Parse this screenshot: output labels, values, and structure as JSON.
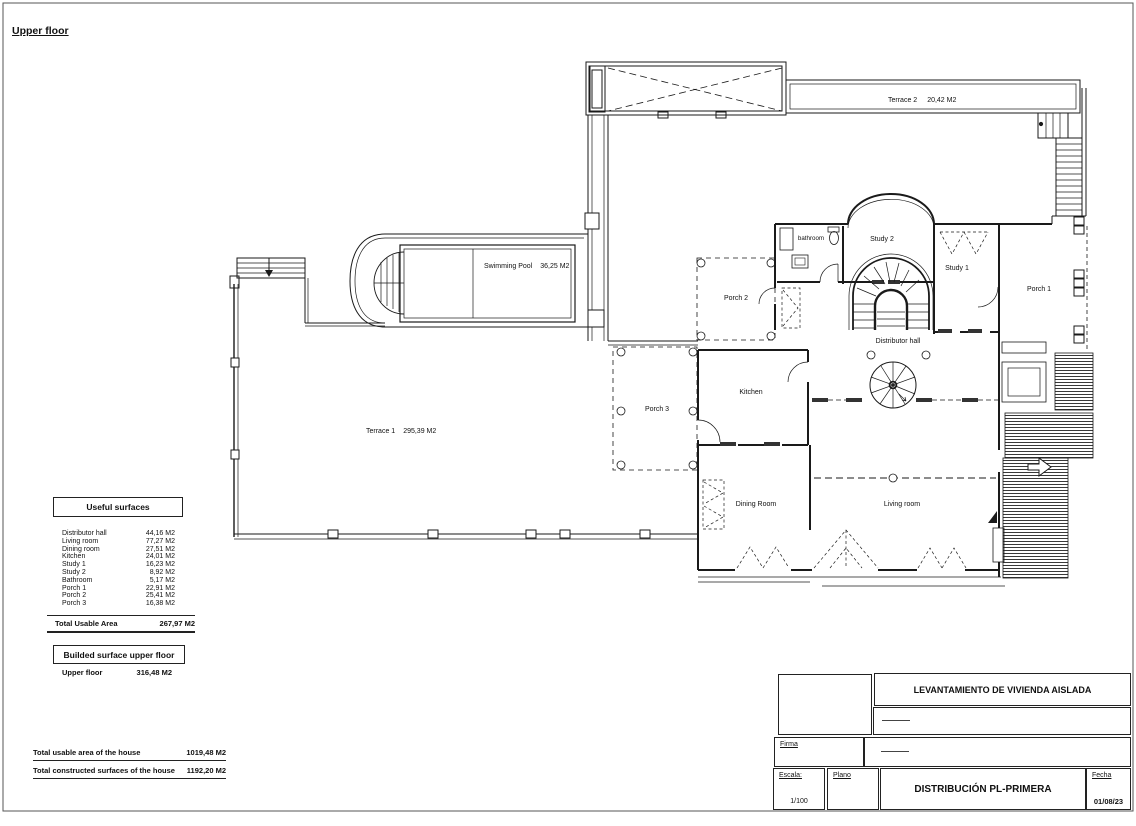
{
  "sheet": {
    "title": "Upper floor"
  },
  "plan": {
    "terrace2": {
      "name": "Terrace 2",
      "area": "20,42 M2"
    },
    "swimming_pool": {
      "name": "Swimming Pool",
      "area": "36,25 M2"
    },
    "terrace1": {
      "name": "Terrace 1",
      "area": "295,39  M2"
    },
    "rooms": {
      "bathroom": "bathroom",
      "study2": "Study 2",
      "study1": "Study 1",
      "porch1": "Porch 1",
      "porch2": "Porch 2",
      "porch3": "Porch 3",
      "distributor_hall": "Distributor hall",
      "kitchen": "Kitchen",
      "dining_room": "Dining Room",
      "living_room": "Living room"
    }
  },
  "surfaces": {
    "title": "Useful surfaces",
    "rows": [
      {
        "label": "Distributor hall",
        "value": "44,16  M2"
      },
      {
        "label": "Living room",
        "value": "77,27  M2"
      },
      {
        "label": "Dining room",
        "value": "27,51  M2"
      },
      {
        "label": "Kitchen",
        "value": "24,01  M2"
      },
      {
        "label": "Study 1",
        "value": "16,23  M2"
      },
      {
        "label": "Study 2",
        "value": "8,92  M2"
      },
      {
        "label": "Bathroom",
        "value": "5,17  M2"
      },
      {
        "label": "Porch 1",
        "value": "22,91 M2"
      },
      {
        "label": "Porch 2",
        "value": "25,41 M2"
      },
      {
        "label": "Porch 3",
        "value": "16,38 M2"
      }
    ],
    "total_label": "Total Usable Area",
    "total_value": "267,97 M2",
    "built_title": "Builded surface upper floor",
    "built_label": "Upper floor",
    "built_value": "316,48 M2"
  },
  "totals": {
    "usable_label": "Total usable area of the house",
    "usable_value": "1019,48 M2",
    "constructed_label": "Total constructed surfaces of the house",
    "constructed_value": "1192,20 M2"
  },
  "title_block": {
    "project_title": "LEVANTAMIENTO DE VIVIENDA AISLADA",
    "firma_label": "Firma",
    "escala_label": "Escala:",
    "escala_value": "1/100",
    "plano_label": "Plano",
    "drawing_title": "DISTRIBUCIÓN PL-PRIMERA",
    "fecha_label": "Fecha",
    "fecha_value": "01/08/23"
  },
  "colors": {
    "line": "#1a1a1a",
    "paper": "#ffffff"
  }
}
